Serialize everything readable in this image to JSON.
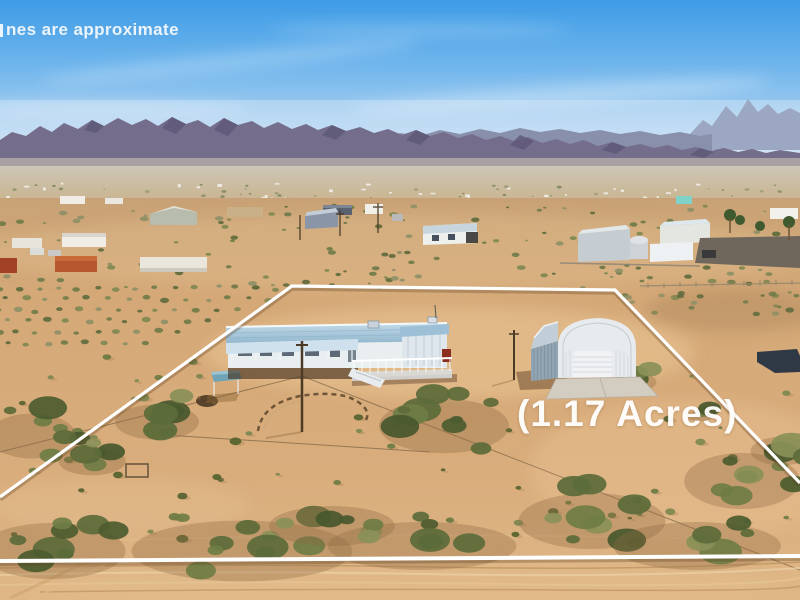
{
  "image_type": "aerial-drone-photo-real-estate",
  "watermark": {
    "visible_text": "nes are approximate"
  },
  "acreage_label": {
    "text": "(1.17 Acres)"
  },
  "scene_objects": [
    "sky",
    "mountain-range",
    "desert-valley",
    "manufactured-home",
    "metal-garage",
    "property-boundary",
    "dirt-road",
    "desert-shrubs"
  ],
  "palette": {
    "sky_top": "#3e9ce6",
    "sky_horizon": "#dcebf7",
    "mountains_far": "#9ca7c4",
    "mountains_mid": "#8890ac",
    "mountains_near": "#756d8c",
    "valley_haze": "#cdc5b4",
    "sand_mid": "#cfa87a",
    "sand_foreground": "#d6a876",
    "sand_light": "#e8c597",
    "vegetation_dark": "#4d5c2f",
    "vegetation_mid": "#6b7a42",
    "boundary_line": "#ffffff",
    "house_roof": "#a5c8dd",
    "house_wall": "#e9eef1",
    "garage_metal": "#c3ccd3",
    "text_color": "#ffffff"
  }
}
